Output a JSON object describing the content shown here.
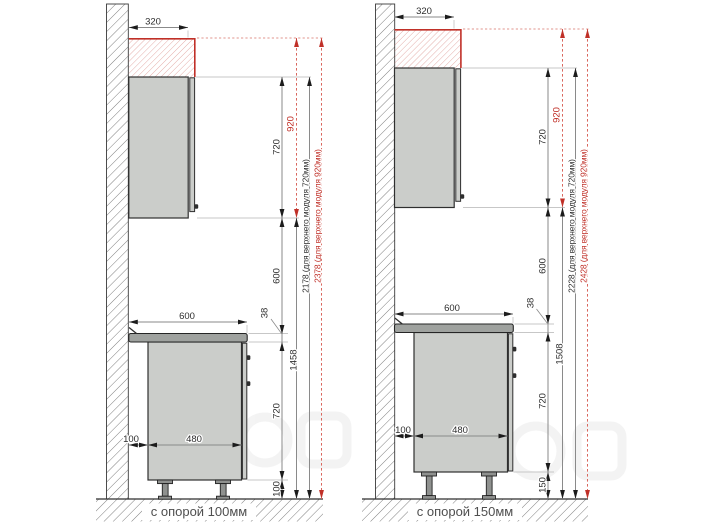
{
  "panels": [
    {
      "caption": "с опорой 100мм",
      "dims": {
        "depth_top": "320",
        "upper_height": "720",
        "upper_height_alt": "920",
        "gap_wall_counter": "600",
        "counter_width": "600",
        "counter_thickness": "38",
        "floor_to_upper": "1458",
        "base_height": "720",
        "leg_height": "100",
        "wall_offset": "100",
        "base_body_width": "480",
        "total_h720": "2178 (для верхнего модуля 720мм)",
        "total_h920": "2378 (для верхнего модуля 920мм)"
      }
    },
    {
      "caption": "с опорой 150мм",
      "dims": {
        "depth_top": "320",
        "upper_height": "720",
        "upper_height_alt": "920",
        "gap_wall_counter": "600",
        "counter_width": "600",
        "counter_thickness": "38",
        "floor_to_upper": "1508",
        "base_height": "720",
        "leg_height": "150",
        "wall_offset": "100",
        "base_body_width": "480",
        "total_h720": "2228 (для верхнего модуля 720мм)",
        "total_h920": "2428 (для верхнего модуля 920мм)"
      }
    }
  ],
  "colors": {
    "accent_red": "#c03028",
    "cabinet_fill": "#cbcdca",
    "dimension_text": "#2e2e2e",
    "caption_text": "#4f4f4f"
  }
}
